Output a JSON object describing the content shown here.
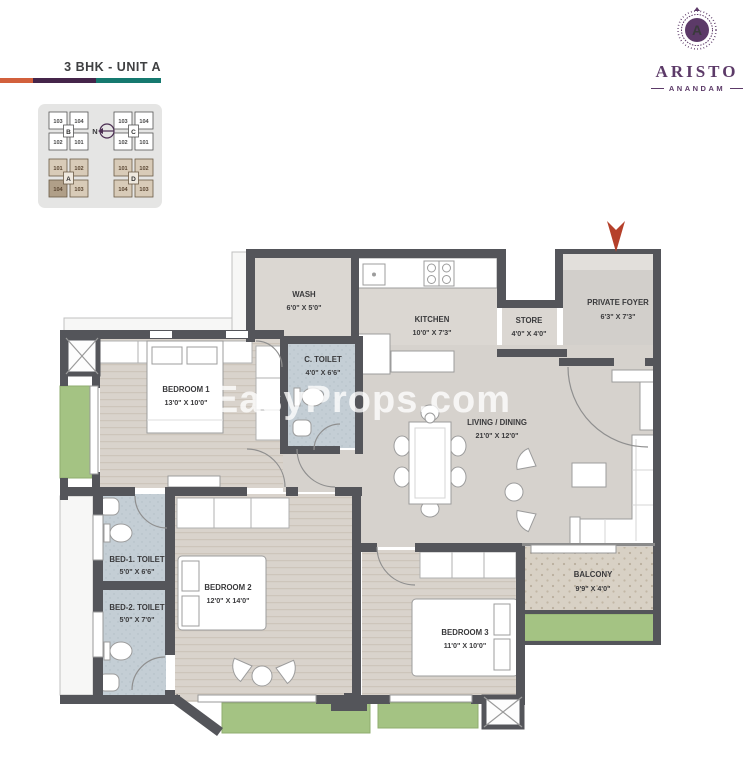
{
  "header": {
    "title": "3 BHK - UNIT A",
    "bar_colors": [
      "#d2603c",
      "#45254a",
      "#15796f"
    ],
    "logo": {
      "brand": "ARISTO",
      "sub": "ANANDAM",
      "monogram": "A",
      "accent": "#5c3a68"
    }
  },
  "key_plan": {
    "north_label": "N",
    "blocks": [
      {
        "letter": "B",
        "style": "white",
        "units": [
          "103",
          "104",
          "102",
          "101"
        ]
      },
      {
        "letter": "C",
        "style": "white",
        "units": [
          "103",
          "104",
          "102",
          "101"
        ]
      },
      {
        "letter": "A",
        "style": "tan",
        "units": [
          "101",
          "102",
          "104",
          "103"
        ],
        "highlighted_unit": "104"
      },
      {
        "letter": "D",
        "style": "tan",
        "units": [
          "101",
          "102",
          "104",
          "103"
        ]
      }
    ]
  },
  "entry": {
    "marker_color": "#b5402a"
  },
  "watermark": "EasyProps.com",
  "rooms": {
    "wash": {
      "name": "WASH",
      "dims": "6'0\" X 5'0\""
    },
    "kitchen": {
      "name": "KITCHEN",
      "dims": "10'0\" X 7'3\""
    },
    "store": {
      "name": "STORE",
      "dims": "4'0\" X 4'0\""
    },
    "private_foyer": {
      "name": "PRIVATE FOYER",
      "dims": "6'3\" X 7'3\""
    },
    "c_toilet": {
      "name": "C. TOILET",
      "dims": "4'0\" X 6'6\""
    },
    "bedroom1": {
      "name": "BEDROOM 1",
      "dims": "13'0\" X 10'0\""
    },
    "living_dining": {
      "name": "LIVING / DINING",
      "dims": "21'0\" X 12'0\""
    },
    "bed1_toilet": {
      "name": "BED-1. TOILET",
      "dims": "5'0\" X 6'6\""
    },
    "bed2_toilet": {
      "name": "BED-2. TOILET",
      "dims": "5'0\" X 7'0\""
    },
    "bedroom2": {
      "name": "BEDROOM 2",
      "dims": "12'0\" X 14'0\""
    },
    "bedroom3": {
      "name": "BEDROOM 3",
      "dims": "11'0\" X 10'0\""
    },
    "balcony": {
      "name": "BALCONY",
      "dims": "9'9\" X 4'0\""
    }
  }
}
